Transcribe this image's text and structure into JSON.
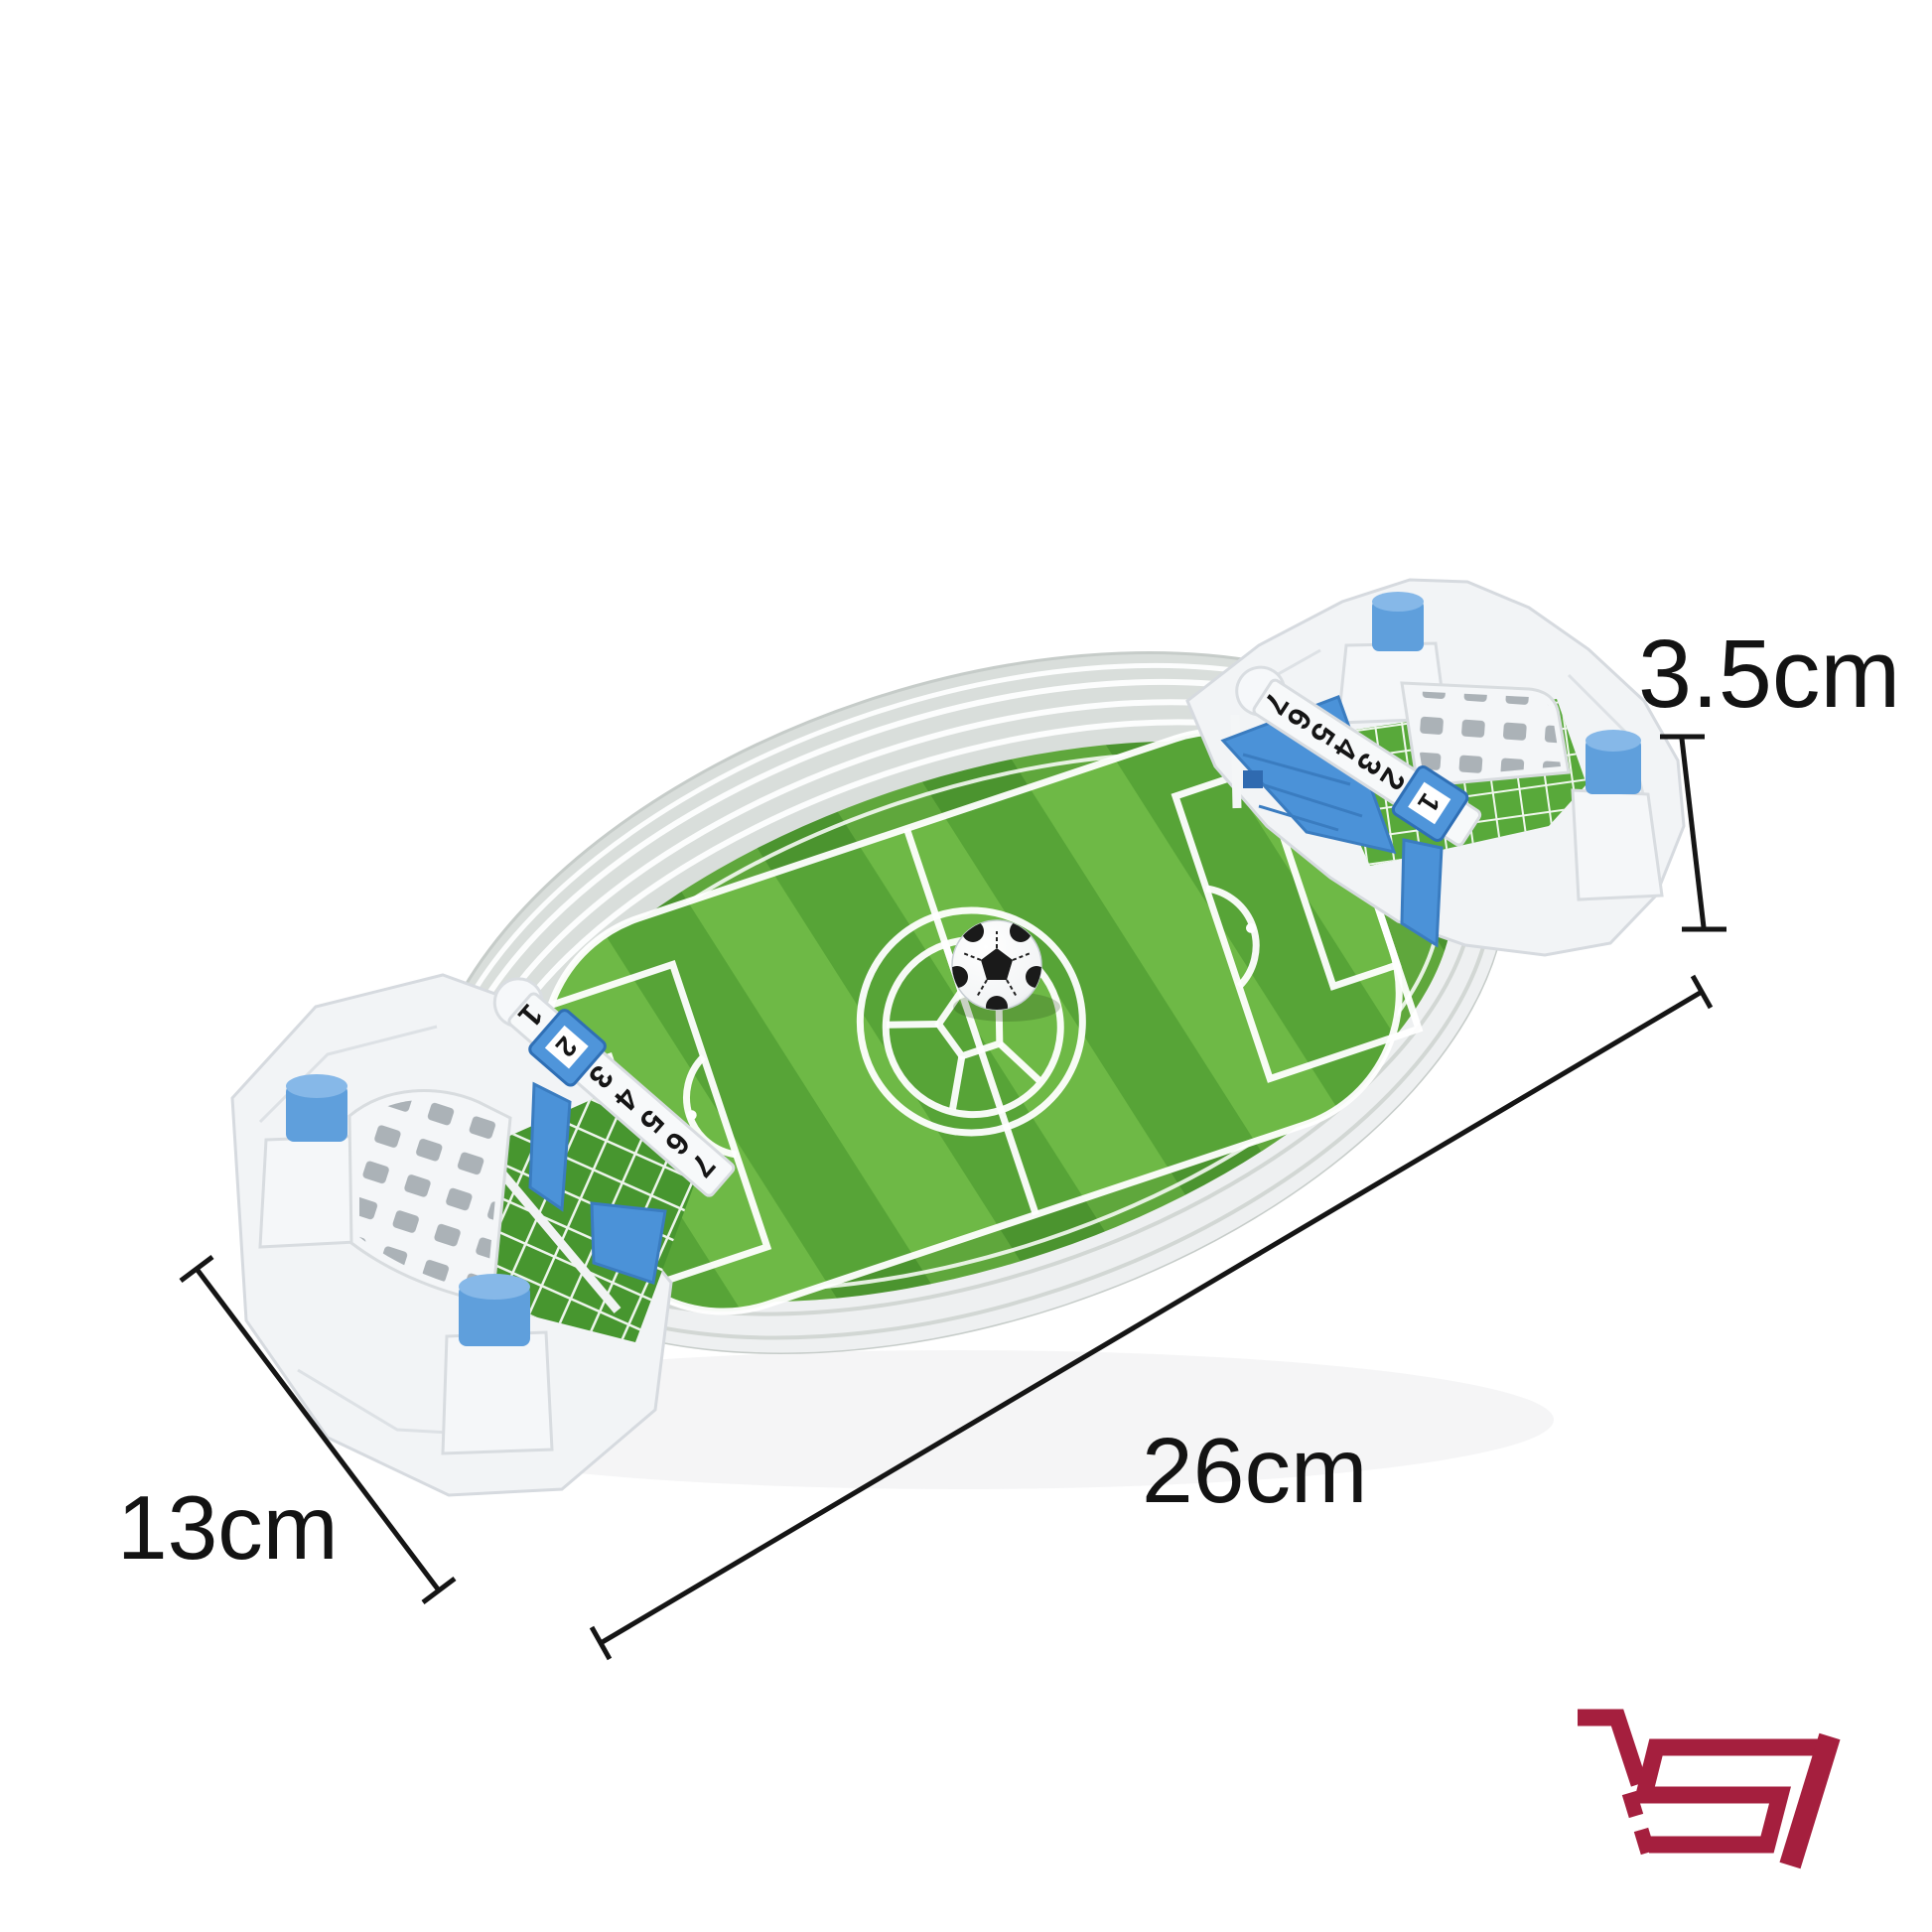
{
  "scene": {
    "background": "#ffffff",
    "description": "Product photo of a white tabletop interactive football (soccer) stadium toy with blue buttons, score rails, a mini soccer ball and printed size annotations"
  },
  "dimension_annotations": {
    "height": {
      "label": "3.5cm"
    },
    "length": {
      "label": "26cm"
    },
    "width": {
      "label": "13cm"
    },
    "line_color": "#151515"
  },
  "toy": {
    "score_rail_numbers": [
      "1",
      "2",
      "3",
      "4",
      "5",
      "6",
      "7"
    ],
    "score_rail_numbers_reversed": [
      "7",
      "6",
      "5",
      "4",
      "3",
      "2"
    ],
    "left_score_marker_value": "2",
    "right_score_marker_value": "1",
    "colors": {
      "plastic_white": "#f3f5f7",
      "grandstand_gray": "#d9dedb",
      "pitch_green_light": "#6eb946",
      "pitch_green_dark": "#57a437",
      "net_green": "#47962f",
      "accent_blue": "#5f9fdc",
      "flipper_blue": "#4b92d8"
    }
  },
  "logo": {
    "icon": "shopping-cart-logo",
    "color": "#a51f3e"
  }
}
